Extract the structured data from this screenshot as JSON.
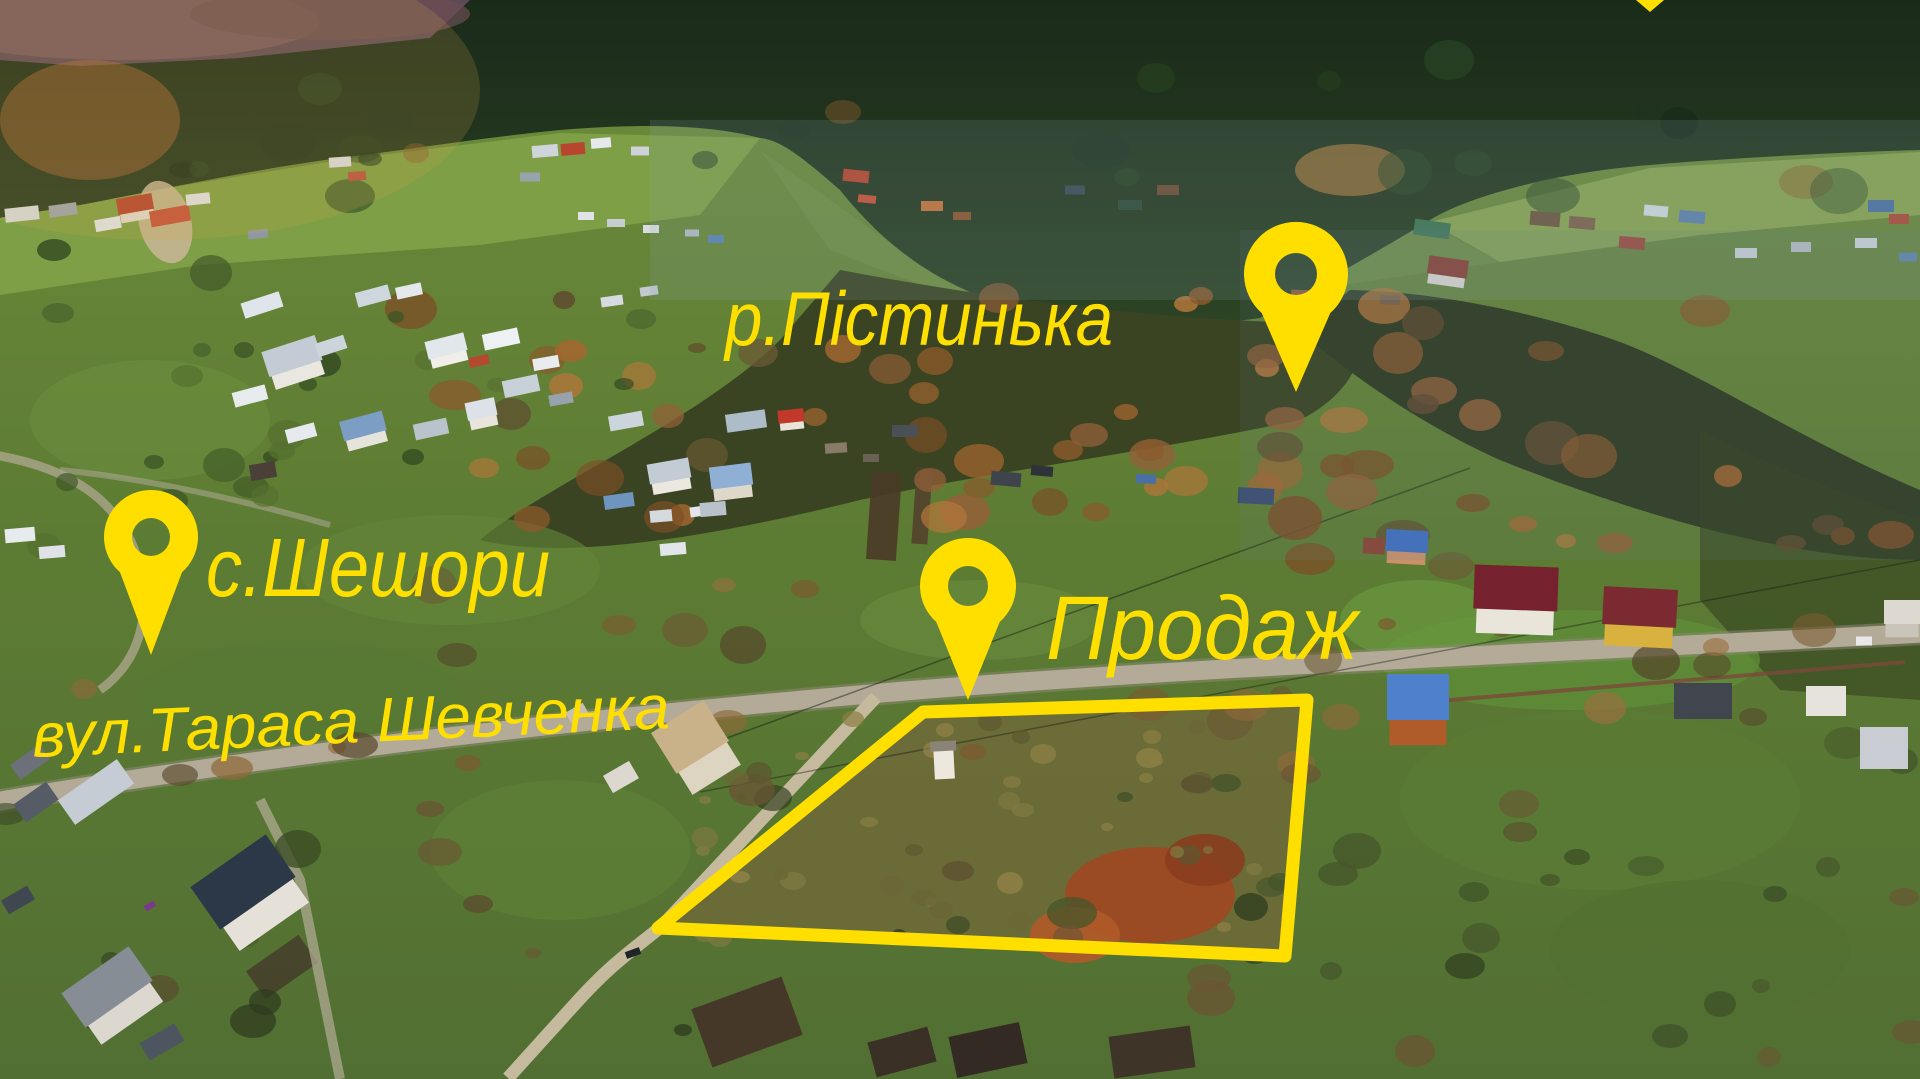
{
  "annotations": {
    "color": "#ffdf00",
    "labels": {
      "river": {
        "text": "р.Пістинька"
      },
      "village": {
        "text": "с.Шешори"
      },
      "street": {
        "text": "вул.Тараса Шевченка"
      },
      "sale": {
        "text": "Продаж"
      }
    },
    "pins": [
      {
        "id": "pin-river",
        "cx": 1296,
        "cy": 274,
        "r": 52,
        "hole": 21,
        "tip": 392
      },
      {
        "id": "pin-village",
        "cx": 151,
        "cy": 537,
        "r": 47,
        "hole": 19,
        "tip": 655
      },
      {
        "id": "pin-sale",
        "cx": 968,
        "cy": 586,
        "r": 48,
        "hole": 20,
        "tip": 700
      }
    ],
    "partial_pin_tip": {
      "points": [
        [
          1636,
          0
        ],
        [
          1664,
          0
        ],
        [
          1650,
          12
        ]
      ]
    },
    "plot_outline": {
      "points": [
        [
          923,
          712
        ],
        [
          1307,
          700
        ],
        [
          1285,
          956
        ],
        [
          658,
          928
        ]
      ],
      "stroke_width": 13
    }
  }
}
